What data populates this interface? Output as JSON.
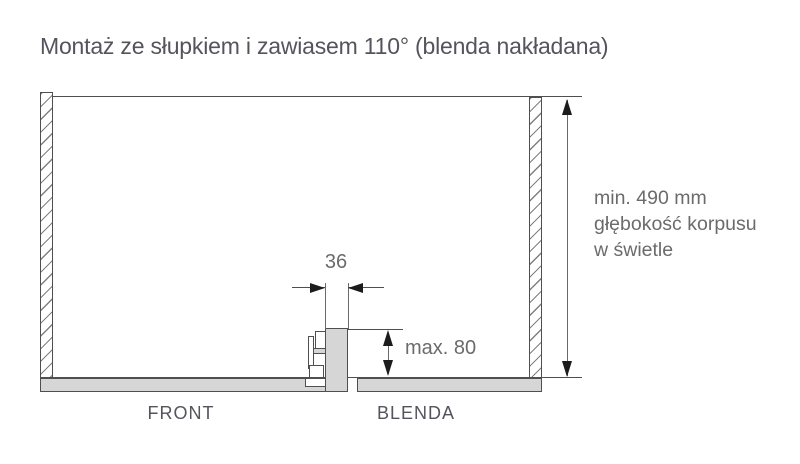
{
  "title": "Montaż ze słupkiem i zawiasem 110° (blenda nakładana)",
  "diagram": {
    "dim_post_width": "36",
    "dim_blenda_overlap": "max. 80",
    "depth_note": {
      "line1": "min. 490 mm",
      "line2": "głębokość korpusu",
      "line3": "w świetle"
    },
    "label_front": "FRONT",
    "label_blenda": "BLENDA",
    "colors": {
      "line": "#4f4f4f",
      "panel_fill": "#d6d6d6",
      "hatch": "#808080",
      "arrow": "#1c1c1c",
      "dim_text": "#6b6b6b",
      "heading_text": "#54555c"
    }
  }
}
